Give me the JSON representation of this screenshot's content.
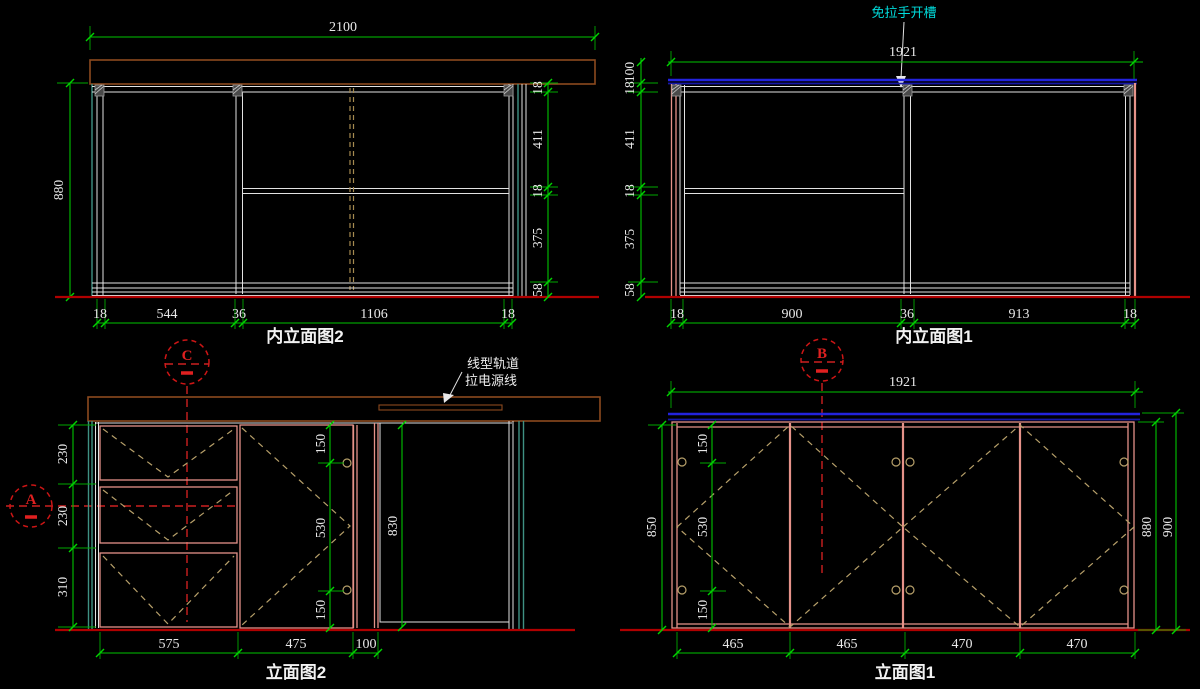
{
  "colors": {
    "background": "#000000",
    "dimension_green": "#00c400",
    "structure_white": "#e2e2e2",
    "countertop_brown": "#8c4a1e",
    "panel_pink": "#e59289",
    "swing_tan": "#b7a06a",
    "edge_teal": "#3f9183",
    "baseline_red": "#b00000",
    "centerline_red": "#cc2020",
    "top_blue": "#2323dd",
    "note_cyan": "#00dcdc"
  },
  "top_left": {
    "title": "内立面图2",
    "dim_top": "2100",
    "dim_left": "880",
    "right_chain": [
      "18",
      "411",
      "18",
      "375",
      "58"
    ],
    "bottom_chain": [
      "18",
      "544",
      "36",
      "1106",
      "18"
    ]
  },
  "top_right": {
    "title": "内立面图1",
    "dim_top": "1921",
    "note": "免拉手开槽",
    "left_chain": [
      "100",
      "18",
      "411",
      "18",
      "375",
      "58"
    ],
    "bottom_chain": [
      "18",
      "900",
      "36",
      "913",
      "18"
    ]
  },
  "bottom_left": {
    "title": "立面图2",
    "note_line1": "线型轨道",
    "note_line2": "拉电源线",
    "left_chain": [
      "230",
      "230",
      "310"
    ],
    "mid_chain": [
      "150",
      "530",
      "150"
    ],
    "open_height": "830",
    "bottom_chain": [
      "575",
      "475",
      "100"
    ]
  },
  "bottom_right": {
    "title": "立面图1",
    "dim_top": "1921",
    "left_outer": "850",
    "left_chain": [
      "150",
      "530",
      "150"
    ],
    "right_chain": [
      "880",
      "900"
    ],
    "bottom_chain": [
      "465",
      "465",
      "470",
      "470"
    ]
  },
  "markers": {
    "a": "A",
    "b": "B",
    "c": "C"
  }
}
